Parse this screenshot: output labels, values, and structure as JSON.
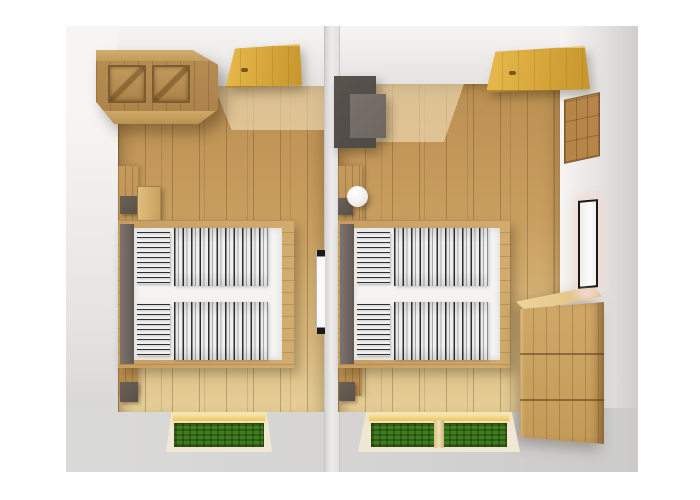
{
  "scene": {
    "view": "top-down-3d-floor-plan",
    "text_content": "none",
    "rooms": [
      {
        "name": "left-bedroom",
        "furniture": [
          "wooden-wardrobe-two-doors",
          "open-golden-door",
          "wood-headboard-wall-panel",
          "dark-wall-shelf-upper",
          "wooden-nightstand",
          "double-bed-wood-frame",
          "gray-upholstered-headboard",
          "two-striped-pillows",
          "two-striped-duvets",
          "edge-on-wall-mirror",
          "dark-wall-shelf-lower",
          "window-with-grass-view"
        ]
      },
      {
        "name": "right-bedroom",
        "furniture": [
          "gray-armchair",
          "open-golden-door",
          "round-ceiling-lamp",
          "wood-headboard-wall-panel",
          "dark-wall-shelf-upper",
          "double-bed-wood-frame",
          "gray-upholstered-headboard",
          "two-striped-pillows",
          "two-striped-duvets",
          "wooden-chest-of-drawers-three-rows",
          "wooden-wall-decor-panel",
          "illuminated-wall-mirror",
          "dark-wall-shelf-lower",
          "double-window-with-grass-view"
        ]
      }
    ]
  },
  "colors": {
    "page-bg": "#ffffff",
    "wall-light": "#f6f5f3",
    "wall-mid": "#e3e2e0",
    "wall-dark": "#cfcecc",
    "middle-wall": "#edecea",
    "floor-top": "#bb8f51",
    "floor-mid": "#c99f60",
    "floor-light": "#d9b97e",
    "floor-pale": "#e7cf98",
    "wood-front": "#a9824b",
    "wood-light": "#d2ad6f",
    "wood-edge": "#7d5c2e",
    "door-gold-light": "#e9ba4c",
    "door-gold-dark": "#c6952c",
    "headboard": "#6e655f",
    "mattress": "#f4f3f1",
    "stripe-dark": "#2f2f2f",
    "stripe-light": "#f0f0f0",
    "chair-dark": "#4e4a46",
    "chair-mid": "#6e6761",
    "shelf-dark": "#5a5148",
    "lamp-white": "#ffffff",
    "grass-dark": "#2e5f13",
    "grass-light": "#3f7e1f",
    "glow-gold": "#fae29c",
    "frame-wood": "#d9c188",
    "dresser-front": "#c49a58",
    "dresser-top": "#ecd49a",
    "panel-wood": "#b5854a",
    "mirror-frame": "#1b1917",
    "mirror-face": "#fbfbfa",
    "glow-pink": "#f3d8d2"
  }
}
